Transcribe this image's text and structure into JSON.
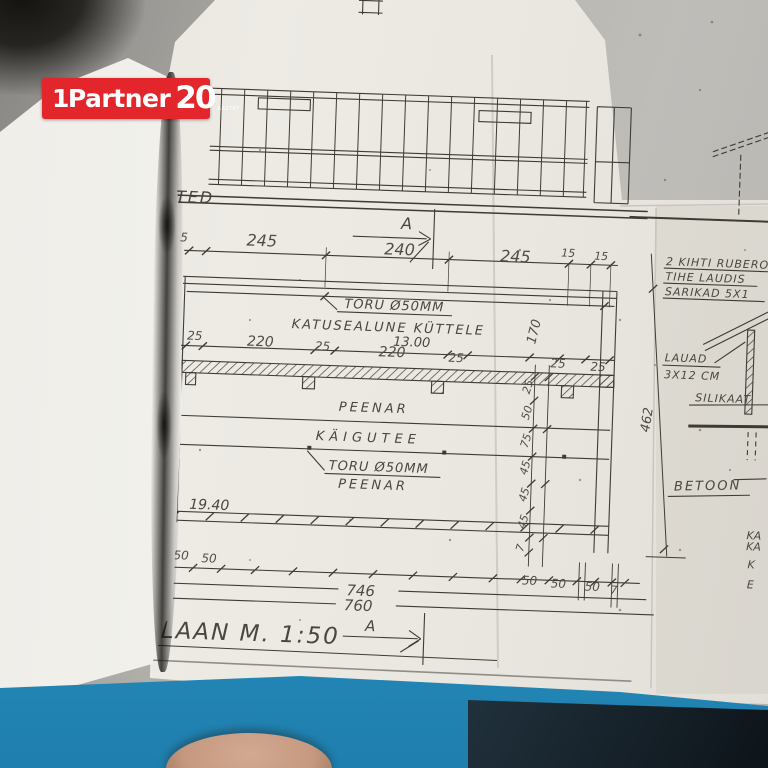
{
  "logo": {
    "prefix": "1",
    "brand": "Partner",
    "number": "20",
    "suffix": "AASTAT",
    "bg": "#e2262c"
  },
  "drawing": {
    "edge_text": "TED",
    "section_label_top": "A",
    "section_label_bottom": "A",
    "title": "ÕHIPLAAN  M. 1:50",
    "top_dims": [
      "15",
      "245",
      "240",
      "245",
      "15",
      "15"
    ],
    "mid_dims": [
      "25",
      "220",
      "25",
      "220",
      "25",
      "25",
      "25"
    ],
    "vert_dim": "170",
    "diag_dim": "462",
    "level_top": "13.00",
    "level_bottom": "19.40",
    "toru_label_top": "TORU Ø50MM",
    "katusealune_label": "KATUSEALUNE KÜTTELE",
    "peenar_label_1": "PEENAR",
    "kaigutee_label": "KÄIGUTEE",
    "toru_label_mid": "TORU Ø50MM",
    "peenar_label_2": "PEENAR",
    "left_chain_dims": [
      "25",
      "50",
      "75",
      "45",
      "45",
      "45",
      "7"
    ],
    "bottom_dims_left": [
      "7",
      "50",
      "50"
    ],
    "bottom_dims_right": [
      "50",
      "50",
      "50",
      "7"
    ],
    "total_1": "746",
    "total_2": "760",
    "notes": {
      "note1": "2 KIHTI RUBERO",
      "note2": "TIHE LAUDIS",
      "note3": "SARIKAD 5X1",
      "lauad_1": "LAUAD",
      "lauad_2": "3X12 CM",
      "silikaat": "SILIKAAT",
      "betoon": "BETOON",
      "partial_1": "KA",
      "partial_2": "KA",
      "partial_3": "K",
      "partial_4": "E"
    }
  }
}
